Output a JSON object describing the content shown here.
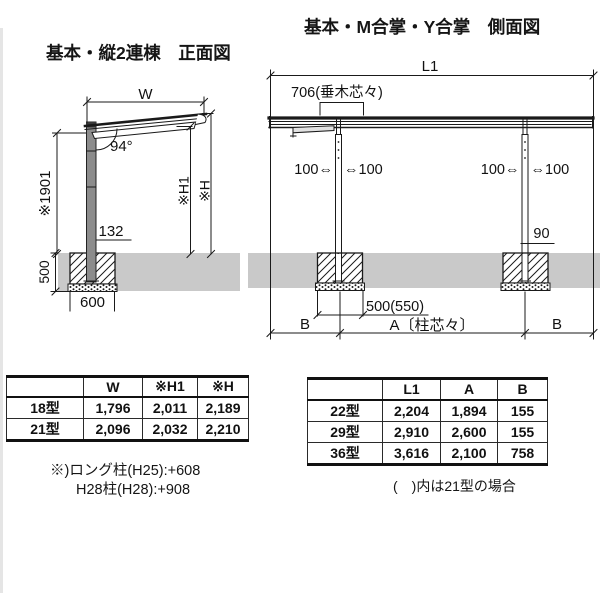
{
  "titles": {
    "front": "基本・縦2連棟　正面図",
    "side": "基本・M合掌・Y合掌　側面図"
  },
  "front_view": {
    "width_label": "W",
    "angle": "94°",
    "post_height": "※1901",
    "post_offset": "132",
    "eave_height": "※H1",
    "total_height": "※H",
    "embed_depth": "500",
    "footing_width": "600"
  },
  "side_view": {
    "length_label": "L1",
    "rafter_spacing": "706(垂木芯々)",
    "offset_left": "100⇔",
    "offset_right": "⇔100",
    "post_size": "90",
    "footing_width": "500(550)",
    "side_b": "B",
    "span_a": "A〔柱芯々〕"
  },
  "size_table_front": {
    "headers": [
      "",
      "W",
      "※H1",
      "※H"
    ],
    "rows": [
      {
        "label": "18型",
        "values": [
          "1,796",
          "2,011",
          "2,189"
        ]
      },
      {
        "label": "21型",
        "values": [
          "2,096",
          "2,032",
          "2,210"
        ]
      }
    ]
  },
  "size_table_side": {
    "headers": [
      "",
      "L1",
      "A",
      "B"
    ],
    "rows": [
      {
        "label": "22型",
        "values": [
          "2,204",
          "1,894",
          "155"
        ]
      },
      {
        "label": "29型",
        "values": [
          "2,910",
          "2,600",
          "155"
        ]
      },
      {
        "label": "36型",
        "values": [
          "3,616",
          "2,100",
          "758"
        ]
      }
    ]
  },
  "notes": {
    "front_line1": "※)ロング柱(H25):+608",
    "front_line2": "H28柱(H28):+908",
    "side": "(　)内は21型の場合"
  },
  "colors": {
    "line": "#1a1a1a",
    "ground": "#c9c9c9",
    "post_fill": "#8c8c8c"
  }
}
